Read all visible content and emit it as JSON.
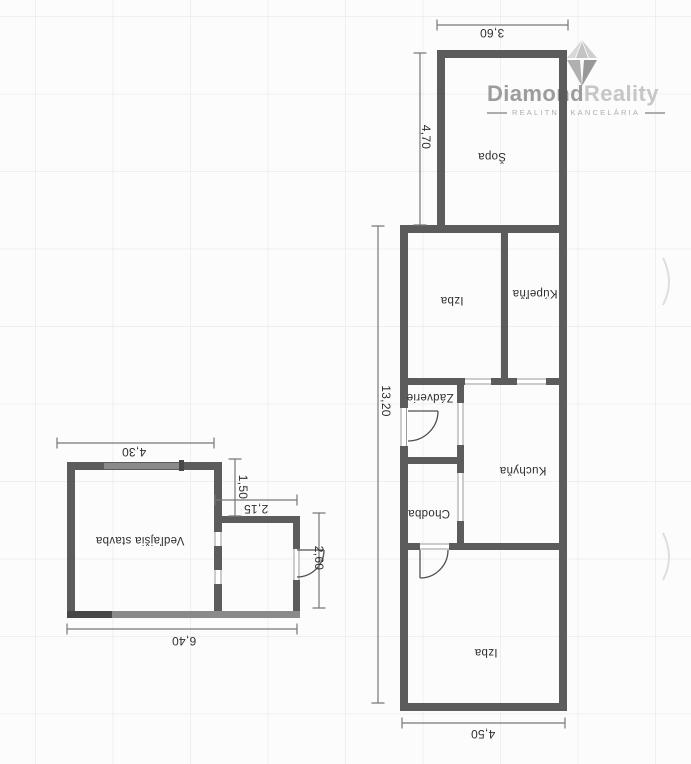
{
  "logo": {
    "brand": {
      "primary": "Diamond",
      "secondary": "Reality"
    },
    "subtitle": "REALITNÁ KANCELÁRIA",
    "icon": "diamond-icon"
  },
  "floor_plan": {
    "orientation_note": "scanned plan, labels rotated 180°",
    "main_building": {
      "rooms": {
        "sopa": "Šopa",
        "izba_upper": "Izba",
        "kupelna": "Kúpeľňa",
        "zadverie": "Zádverie",
        "kuchyna": "Kuchyňa",
        "chodba": "Chodba",
        "izba_lower": "Izba"
      },
      "dimensions": {
        "top_width": "3,60",
        "sopa_height": "4,70",
        "total_height": "13,20",
        "bottom_width": "4,50"
      }
    },
    "outbuilding": {
      "rooms": {
        "vedlajsia_stavba": "Vedľajšia stavba"
      },
      "dimensions": {
        "top_width": "4,30",
        "step_height": "1,50",
        "annex_width": "2,15",
        "annex_height": "2,60",
        "bottom_width": "6,40"
      }
    }
  },
  "theme": {
    "paper": "#fcfcfc",
    "wall": "#5c5c5c",
    "wall_light": "#8a8a8a",
    "wall_dark": "#474747",
    "open_line": "#9a9a9a",
    "dim_line": "#777777",
    "door_line": "#4f4f4f",
    "plan_text": "#2e2e2e",
    "logo_primary": "#9c9c9c",
    "logo_secondary": "#c6c6c6",
    "logo_subtitle": "#adadad",
    "diamond_a": "#d8d8d8",
    "diamond_b": "#c3c3c3",
    "diamond_c": "#cecece",
    "diamond_d": "#b0b0b0",
    "diamond_e": "#989898",
    "artifact": "#dedede",
    "grid": "rgba(110,140,160,0.10)"
  }
}
